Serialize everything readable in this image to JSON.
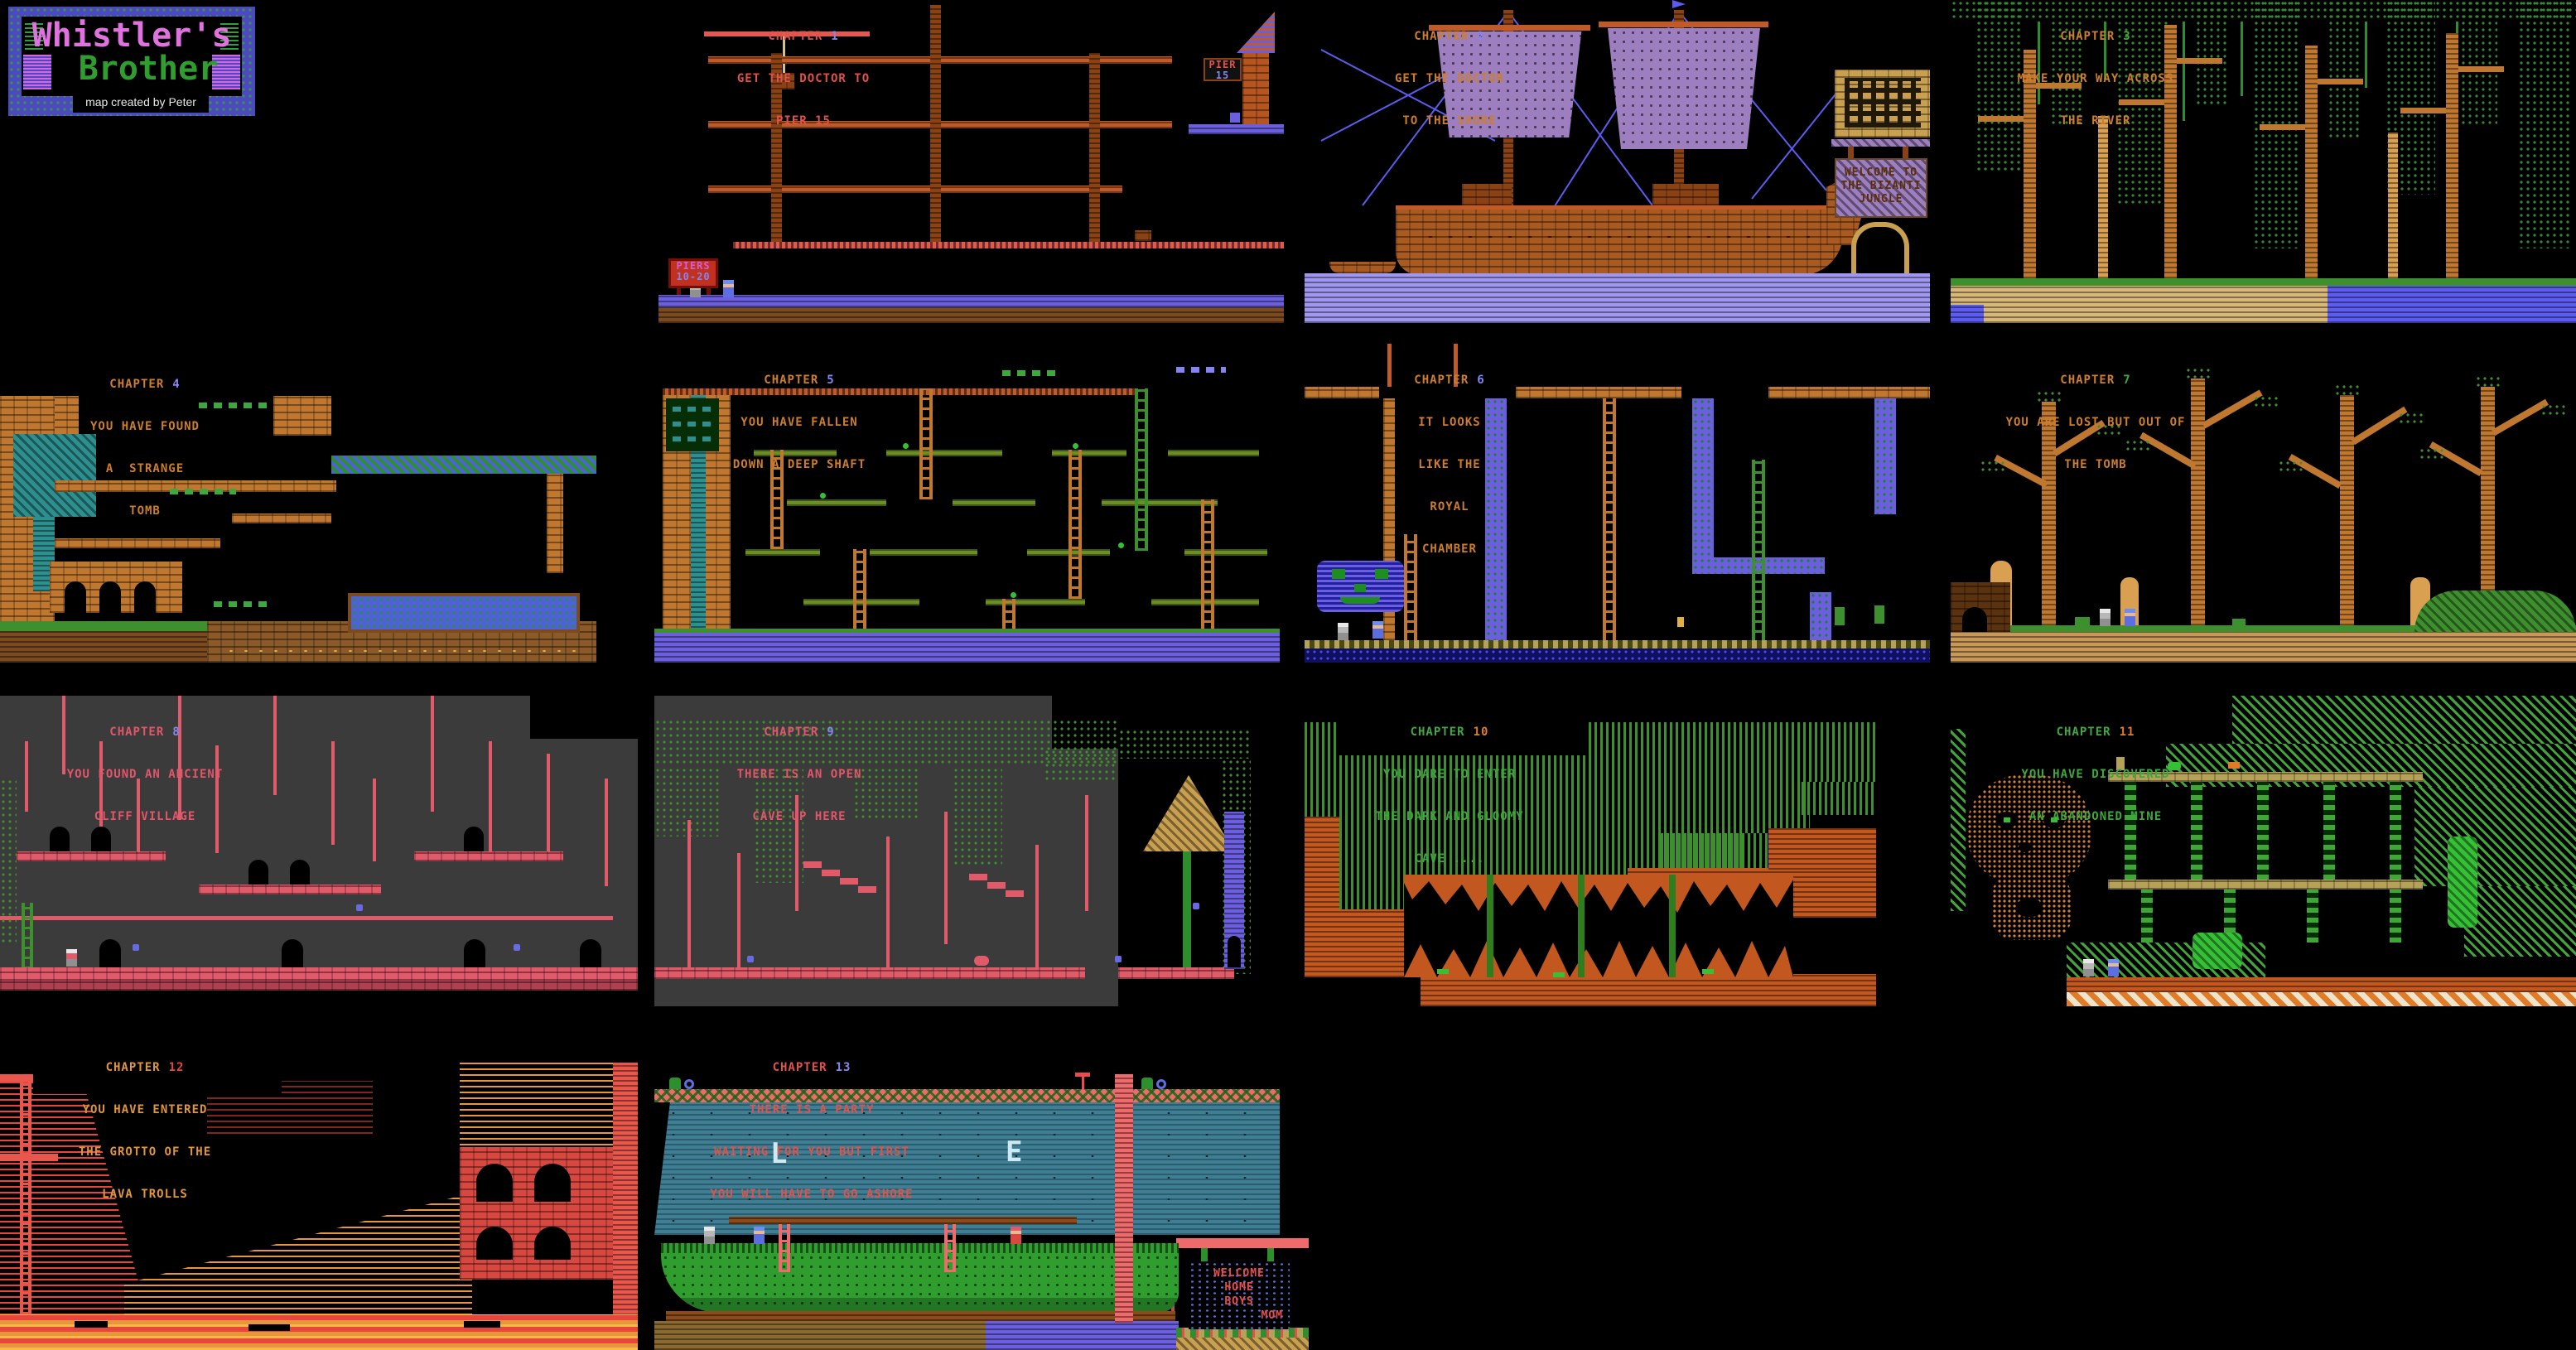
{
  "page": {
    "background": "#000000"
  },
  "logo": {
    "line1": "Whistler's",
    "line2": "Brother",
    "credit": "map created by Peter",
    "colors": {
      "line1": "#df72df",
      "line2": "#2f9e2f",
      "border": "#4f49c0",
      "wave": "#2e9e3e",
      "credit": "#e8e8e8"
    }
  },
  "palette": {
    "platform_orange": "#c05a28",
    "mast_brown": "#8a4215",
    "periwinkle_water": "#6b5fe0",
    "sail_purple": "#9d7fc0",
    "jungle_green": "#2e8e2e",
    "brick_orange": "#c07830",
    "teal": "#2e8f8f",
    "cliff_pink": "#e05a6a",
    "gray_bg": "#3b3b3b",
    "cave_green": "#3e8f2e",
    "cave_orange": "#c2571f",
    "mine_green": "#41a53a",
    "lava_red": "#e8463c",
    "lava_orange": "#e8963c",
    "sea_teal": "#3e7f96",
    "ship_green": "#2f9e2f",
    "deck_pink": "#ef6b6b",
    "sign_blue": "#5c6ee0"
  },
  "chapters": [
    {
      "label": "CHAPTER",
      "number": "1",
      "subtitle": [
        "GET THE DOCTOR TO",
        "PIER 15"
      ],
      "colors": {
        "title": "#e0524a",
        "number": "#8585f0",
        "subtitle": "#e0524a"
      },
      "signs": {
        "piers": [
          "PIERS",
          "10-20"
        ],
        "pier15": [
          "PIER",
          "15"
        ]
      }
    },
    {
      "label": "CHAPTER",
      "number": "2",
      "subtitle": [
        "GET THE DOCTOR",
        "TO THE SHORE"
      ],
      "colors": {
        "title": "#cc7d2e",
        "number": "#8585f0",
        "subtitle": "#cc7d2e"
      },
      "signs": {
        "jungle": [
          "WELCOME TO",
          "THE BIZANTI",
          "JUNGLE"
        ]
      }
    },
    {
      "label": "CHAPTER",
      "number": "3",
      "subtitle": [
        "MAKE YOUR WAY ACROSS",
        "THE RIVER"
      ],
      "colors": {
        "title": "#cc7d2e",
        "number": "#3fa73f",
        "subtitle": "#cc7d2e"
      }
    },
    {
      "label": "CHAPTER",
      "number": "4",
      "subtitle": [
        "YOU HAVE FOUND",
        "A  STRANGE",
        "TOMB"
      ],
      "colors": {
        "title": "#cc7d2e",
        "number": "#8585f0",
        "subtitle": "#cc7d2e"
      }
    },
    {
      "label": "CHAPTER",
      "number": "5",
      "subtitle": [
        "YOU HAVE FALLEN",
        "DOWN A DEEP SHAFT"
      ],
      "colors": {
        "title": "#cc7d2e",
        "number": "#8585f0",
        "subtitle": "#cc7d2e"
      }
    },
    {
      "label": "CHAPTER",
      "number": "6",
      "subtitle": [
        "IT LOOKS",
        "LIKE THE",
        "ROYAL",
        "CHAMBER"
      ],
      "colors": {
        "title": "#cc7d2e",
        "number": "#8585f0",
        "subtitle": "#cc7d2e"
      }
    },
    {
      "label": "CHAPTER",
      "number": "7",
      "subtitle": [
        "YOU ARE LOST BUT OUT OF",
        "THE TOMB"
      ],
      "colors": {
        "title": "#cc7d2e",
        "number": "#3fa73f",
        "subtitle": "#cc7d2e"
      }
    },
    {
      "label": "CHAPTER",
      "number": "8",
      "subtitle": [
        "YOU FOUND AN ANCIENT",
        "CLIFF VILLAGE"
      ],
      "colors": {
        "title": "#e0566a",
        "number": "#8585f0",
        "subtitle": "#e0566a"
      }
    },
    {
      "label": "CHAPTER",
      "number": "9",
      "subtitle": [
        "THERE IS AN OPEN",
        "CAVE UP HERE"
      ],
      "colors": {
        "title": "#e0566a",
        "number": "#8585f0",
        "subtitle": "#e0566a"
      }
    },
    {
      "label": "CHAPTER",
      "number": "10",
      "subtitle": [
        "YOU DARE TO ENTER",
        "THE DARK AND GLOOMY",
        "CAVE ...."
      ],
      "colors": {
        "title": "#3fa73f",
        "number": "#e07b28",
        "subtitle": "#3fa73f"
      }
    },
    {
      "label": "CHAPTER",
      "number": "11",
      "subtitle": [
        "YOU HAVE DISCOVERED",
        "AN ABANDONED MINE"
      ],
      "colors": {
        "title": "#3fa73f",
        "number": "#e07b28",
        "subtitle": "#3fa73f"
      }
    },
    {
      "label": "CHAPTER",
      "number": "12",
      "subtitle": [
        "YOU HAVE ENTERED",
        "THE GROTTO OF THE",
        "LAVA TROLLS"
      ],
      "colors": {
        "title": "#e0963c",
        "number": "#e8463c",
        "subtitle": "#e0963c"
      }
    },
    {
      "label": "CHAPTER",
      "number": "13",
      "subtitle": [
        "THERE IS A PARTY",
        "WAITING FOR YOU BUT FIRST",
        "YOU WILL HAVE TO GO ASHORE"
      ],
      "colors": {
        "title": "#e0524a",
        "number": "#8585f0",
        "subtitle": "#e0524a"
      },
      "signs": {
        "home": [
          "WELCOME",
          "HOME",
          "BOYS",
          "MOM"
        ]
      },
      "water_letters": [
        "L",
        "E"
      ]
    }
  ]
}
